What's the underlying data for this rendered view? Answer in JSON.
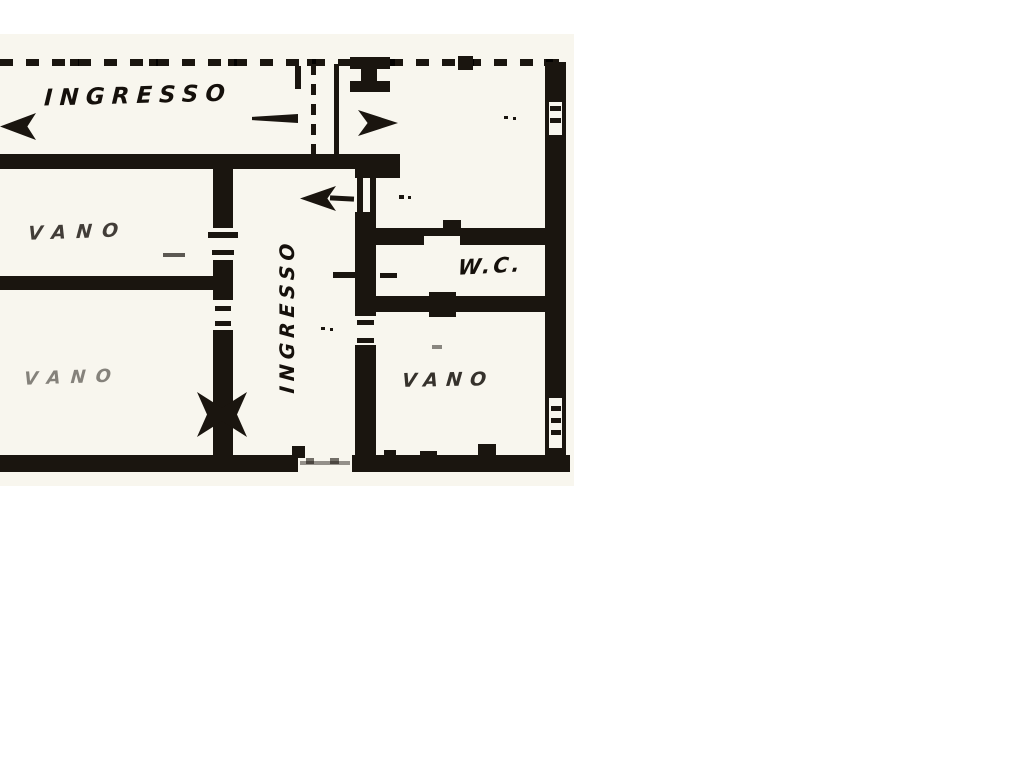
{
  "plan": {
    "rooms": {
      "entrance_label": "INGRESSO",
      "hall_label": "INGRESSO",
      "vano_top_left_label": "VANO",
      "vano_bottom_left_label": "VANO",
      "vano_bottom_right_label": "VANO",
      "wc_label": "W.C."
    },
    "colors": {
      "ink": "#1a150f",
      "paper": "#f8f6ee",
      "canvas": "#ffffff"
    },
    "icons": {
      "direction-arrow-left-icon": "filled left arrowhead",
      "direction-arrow-right-icon": "filled right arrowhead",
      "door-hinge-icon": "four-point star hinge mark",
      "window-icon": "wall opening with tick marks"
    }
  }
}
